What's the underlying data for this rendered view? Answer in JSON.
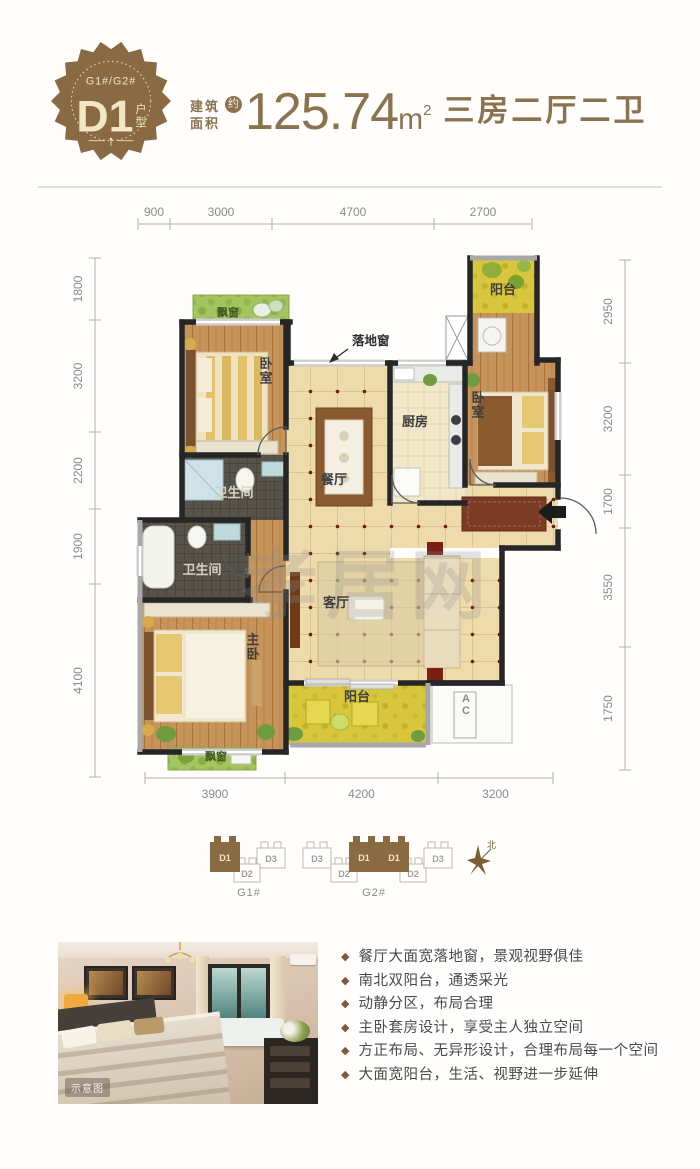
{
  "header": {
    "badge": {
      "building_range": "G1#/G2#",
      "unit_code": "D1",
      "unit_suffix": "户型"
    },
    "area_prefix_line1": "建筑",
    "area_prefix_line2": "面积",
    "approx_mark": "约",
    "area_value": "125.74",
    "area_unit": "m",
    "area_sup": "2",
    "layout_desc": "三房二厅二卫",
    "accent_color": "#8b7350"
  },
  "floorplan": {
    "watermark": "孝居网",
    "window_note": "落地窗",
    "colors": {
      "wall_dark": "#262626",
      "wall_gray": "#a8a8a8",
      "window": "#cdcdcd",
      "wood": "#c6935a",
      "tile": "#eedbac",
      "kitchen_tile": "#f2e8c9",
      "bath": "#57524a",
      "bay_green": "#a3c45e",
      "balcony_yellow": "#d8c73c"
    },
    "dimensions": {
      "top": {
        "labels": [
          "900",
          "3000",
          "4700",
          "2700"
        ],
        "ticks": [
          138,
          170,
          272,
          434,
          532
        ],
        "line": 224
      },
      "bottom": {
        "labels": [
          "3900",
          "4200",
          "3200"
        ],
        "ticks": [
          145,
          285,
          438,
          553
        ],
        "line": 778
      },
      "left": {
        "labels": [
          "1800",
          "3200",
          "2200",
          "1900",
          "4100"
        ],
        "ticks": [
          258,
          320,
          432,
          509,
          584,
          777
        ],
        "line": 95
      },
      "right": {
        "labels": [
          "2950",
          "3200",
          "1700",
          "3550",
          "1750"
        ],
        "ticks": [
          260,
          363,
          475,
          528,
          647,
          770
        ],
        "line": 625
      }
    },
    "rooms": [
      {
        "id": "bay-window-north",
        "label": "飘窗",
        "x": 193,
        "y": 295,
        "w": 96,
        "h": 30,
        "floor": "green",
        "lx": 228,
        "ly": 316,
        "small": true
      },
      {
        "id": "bedroom-north",
        "label": "卧室",
        "x": 182,
        "y": 324,
        "w": 104,
        "h": 131,
        "floor": "wood",
        "lx": 266,
        "ly": 368,
        "vertical": true
      },
      {
        "id": "bathroom-main",
        "label": "卫生间",
        "x": 182,
        "y": 455,
        "w": 104,
        "h": 65,
        "floor": "bath",
        "lx": 234,
        "ly": 497
      },
      {
        "id": "bathroom-ensuite",
        "label": "卫生间",
        "x": 140,
        "y": 520,
        "w": 108,
        "h": 80,
        "floor": "bath",
        "lx": 202,
        "ly": 574
      },
      {
        "id": "corridor-master",
        "label": "",
        "x": 248,
        "y": 520,
        "w": 38,
        "h": 80,
        "floor": "wood"
      },
      {
        "id": "master-bedroom",
        "label": "主卧",
        "x": 140,
        "y": 600,
        "w": 146,
        "h": 152,
        "floor": "wood",
        "lx": 253,
        "ly": 644,
        "vertical": true
      },
      {
        "id": "bay-window-south",
        "label": "飘窗",
        "x": 168,
        "y": 748,
        "w": 88,
        "h": 22,
        "floor": "green",
        "lx": 216,
        "ly": 760,
        "small": true
      },
      {
        "id": "hallway",
        "label": "",
        "x": 390,
        "y": 485,
        "w": 168,
        "h": 63,
        "floor": "tile"
      },
      {
        "id": "dining-room",
        "label": "餐厅",
        "x": 286,
        "y": 363,
        "w": 104,
        "h": 195,
        "floor": "tile",
        "lx": 334,
        "ly": 484
      },
      {
        "id": "kitchen",
        "label": "厨房",
        "x": 390,
        "y": 363,
        "w": 75,
        "h": 140,
        "floor": "tile2",
        "lx": 415,
        "ly": 426
      },
      {
        "id": "living-room",
        "label": "客厅",
        "x": 286,
        "y": 558,
        "w": 216,
        "h": 125,
        "floor": "tile",
        "lx": 336,
        "ly": 607
      },
      {
        "id": "balcony-north",
        "label": "阳台",
        "x": 470,
        "y": 258,
        "w": 67,
        "h": 55,
        "floor": "yellow",
        "lx": 503,
        "ly": 294
      },
      {
        "id": "corridor-north",
        "label": "",
        "x": 470,
        "y": 313,
        "w": 67,
        "h": 50,
        "floor": "wood"
      },
      {
        "id": "bedroom-east",
        "label": "卧室",
        "x": 465,
        "y": 360,
        "w": 93,
        "h": 125,
        "floor": "wood",
        "lx": 478,
        "ly": 402,
        "vertical": true
      },
      {
        "id": "balcony-south",
        "label": "阳台",
        "x": 286,
        "y": 683,
        "w": 142,
        "h": 62,
        "floor": "yellow",
        "lx": 357,
        "ly": 701
      },
      {
        "id": "ac-platform",
        "label": "AC",
        "x": 432,
        "y": 685,
        "w": 80,
        "h": 58,
        "floor": "plain",
        "lx": 466,
        "ly": 702,
        "vertical": true,
        "small": true
      }
    ]
  },
  "site_plan": {
    "clusters": [
      {
        "name": "G1#",
        "nx": 249,
        "ny": 896,
        "units": [
          {
            "label": "D3",
            "x": 257,
            "y": 842,
            "w": 28,
            "h": 26,
            "highlight": false
          },
          {
            "label": "D2",
            "x": 234,
            "y": 858,
            "w": 26,
            "h": 24,
            "highlight": false
          },
          {
            "label": "D1",
            "x": 210,
            "y": 836,
            "w": 30,
            "h": 36,
            "highlight": true
          }
        ]
      },
      {
        "name": "G2#",
        "nx": 374,
        "ny": 896,
        "units": [
          {
            "label": "D3",
            "x": 303,
            "y": 842,
            "w": 28,
            "h": 26,
            "highlight": false
          },
          {
            "label": "D2",
            "x": 331,
            "y": 858,
            "w": 26,
            "h": 24,
            "highlight": false
          },
          {
            "label": "D2",
            "x": 400,
            "y": 858,
            "w": 26,
            "h": 24,
            "highlight": false
          },
          {
            "label": "D3",
            "x": 424,
            "y": 842,
            "w": 28,
            "h": 26,
            "highlight": false
          },
          {
            "label": "D1",
            "x": 349,
            "y": 836,
            "w": 30,
            "h": 36,
            "highlight": true
          },
          {
            "label": "D1",
            "x": 379,
            "y": 836,
            "w": 30,
            "h": 36,
            "highlight": true
          }
        ]
      }
    ],
    "compass_label": "北"
  },
  "photo": {
    "caption": "示意图"
  },
  "features": {
    "bullet": "◆",
    "items": [
      "餐厅大面宽落地窗，景观视野俱佳",
      "南北双阳台，通透采光",
      "动静分区，布局合理",
      "主卧套房设计，享受主人独立空间",
      "方正布局、无异形设计，合理布局每一个空间",
      "大面宽阳台，生活、视野进一步延伸"
    ]
  }
}
